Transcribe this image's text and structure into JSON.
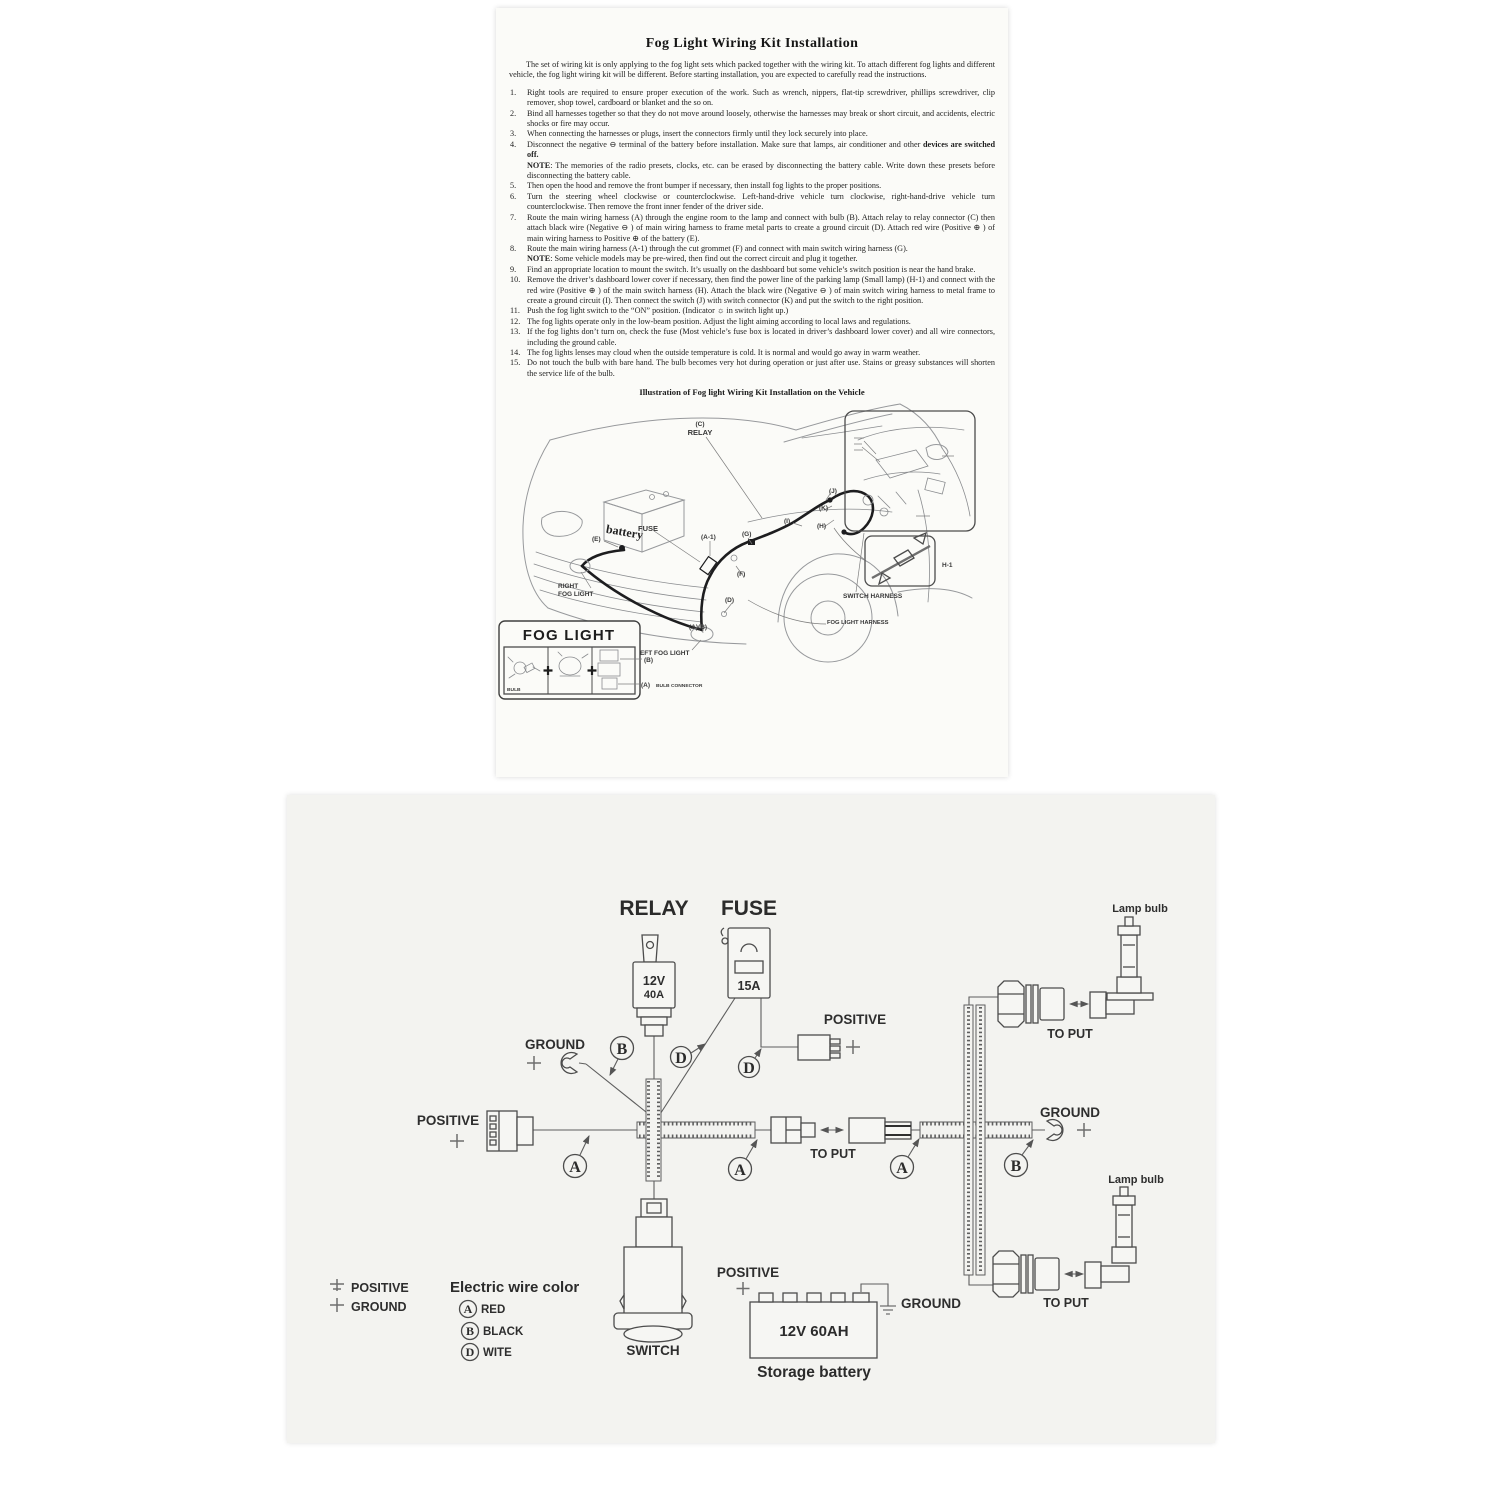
{
  "instruction_sheet": {
    "title": "Fog Light Wiring Kit Installation",
    "intro": "The set of wiring kit is only applying to the fog light sets which packed together with the wiring kit.  To attach different fog lights and different vehicle, the fog light wiring kit will be different.  Before starting installation, you are expected to carefully read the instructions.",
    "items": [
      {
        "num": "1.",
        "text": "Right tools are required to ensure proper execution of the work.  Such as wrench, nippers, flat-tip screwdriver, phillips screwdriver, clip remover, shop towel, cardboard or blanket and the so on."
      },
      {
        "num": "2.",
        "text": "Bind all harnesses together so that they do not move around loosely, otherwise the harnesses may break or short circuit, and accidents, electric shocks or fire may occur."
      },
      {
        "num": "3.",
        "text": "When connecting the harnesses or plugs, insert the connectors firmly until they lock securely into place."
      },
      {
        "num": "4.",
        "text": "Disconnect the negative ⊖ terminal of the battery before installation.  Make sure that lamps, air conditioner and other ",
        "bold": "devices are switched off.",
        "note_label": "NOTE",
        "note_text": ": The memories of the radio presets, clocks, etc. can be erased by disconnecting the battery cable.  Write down these presets before disconnecting the battery cable."
      },
      {
        "num": "5.",
        "text": "Then open the hood and remove the front bumper if necessary, then install fog lights to the proper positions."
      },
      {
        "num": "6.",
        "text": "Turn the steering wheel clockwise or counterclockwise.  Left-hand-drive vehicle turn clockwise, right-hand-drive vehicle turn counterclockwise.  Then remove the front inner fender of the driver side."
      },
      {
        "num": "7.",
        "text": "Route the main wiring harness (A) through the engine room to the lamp and connect with bulb (B).  Attach relay to relay connector (C) then attach black wire (Negative ⊖ ) of main wiring harness to frame metal parts to create a ground circuit (D).  Attach red wire (Positive ⊕ ) of main wiring harness to Positive ⊕  of the battery (E)."
      },
      {
        "num": "8.",
        "text": "Route the main wiring harness (A-1) through the cut grommet (F) and connect with main switch wiring harness (G).",
        "note_label": "NOTE",
        "note_text": ": Some vehicle models may be pre-wired, then find out the correct circuit and plug it together."
      },
      {
        "num": "9.",
        "text": "Find an appropriate location to mount the switch. It’s usually on the dashboard but some vehicle’s switch position is near the hand brake."
      },
      {
        "num": "10.",
        "text": "Remove the driver’s dashboard lower cover if necessary, then find the power line of the parking lamp (Small lamp) (H-1) and connect with the red wire (Positive ⊕ ) of the main switch harness (H).  Attach the black wire (Negative ⊖ ) of main switch wiring harness to metal frame to create a ground circuit (I).  Then connect the switch (J) with switch connector (K) and put the switch to the right position."
      },
      {
        "num": "11.",
        "text": "Push the fog light switch to the “ON” position.  (Indicator ☼ in switch light up.)"
      },
      {
        "num": "12.",
        "text": "The fog lights operate only in the low-beam position.  Adjust the light aiming according to local laws and regulations."
      },
      {
        "num": "13.",
        "text": "If the fog lights don’t turn on, check the fuse (Most vehicle’s fuse box is located in driver’s dashboard lower cover) and all wire connectors, including the ground cable."
      },
      {
        "num": "14.",
        "text": "The fog lights lenses may cloud when the outside temperature is cold. It is normal and would go away in warm weather."
      },
      {
        "num": "15.",
        "text": "Do not touch the bulb with bare hand.  The bulb becomes very hot during operation or just after use.  Stains or greasy substances will shorten the service life of the bulb."
      }
    ],
    "illustration_title": "Illustration of Fog light Wiring Kit Installation on the Vehicle",
    "vehicle": {
      "c": "(C)",
      "relay": "RELAY",
      "battery": "battery",
      "fuse": "FUSE",
      "e": "(E)",
      "a1": "(A-1)",
      "g": "(G)",
      "j": "(J)",
      "k": "(K)",
      "i": "(I)",
      "h": "(H)",
      "f": "(F)",
      "d": "(D)",
      "right_fog_1": "RIGHT",
      "right_fog_2": "FOG LIGHT",
      "ab": "(A)(B)",
      "left_fog": "LEFT  FOG  LIGHT",
      "switch_harness": "SWITCH HARNESS",
      "fog_light_harness": "FOG LIGHT HARNESS",
      "h1": "H-1"
    },
    "fog_light_box": {
      "title": "FOG LIGHT",
      "bulb": "BULB",
      "b": "(B)",
      "a": "(A)",
      "a_desc": "BULB CONNECTOR"
    }
  },
  "wiring_diagram": {
    "relay": {
      "label": "RELAY",
      "volts": "12V",
      "amps": "40A"
    },
    "fuse": {
      "label": "FUSE",
      "amps": "15A"
    },
    "labels": {
      "positive": "POSITIVE",
      "ground": "GROUND",
      "to_put": "TO PUT",
      "lamp_bulb": "Lamp bulb",
      "switch": "SWITCH"
    },
    "battery": {
      "rating": "12V  60AH",
      "caption": "Storage battery"
    },
    "wire_codes": {
      "a": "A",
      "b": "B",
      "d": "D"
    },
    "legend": {
      "positive": "POSITIVE",
      "ground": "GROUND",
      "title": "Electric wire color",
      "entries": [
        {
          "code": "A",
          "color": "RED"
        },
        {
          "code": "B",
          "color": "BLACK"
        },
        {
          "code": "D",
          "color": "WITE"
        }
      ]
    },
    "colors": {
      "paper": "#f3f3f0",
      "ink": "#2e2e2e",
      "line": "#5e5e5e"
    }
  }
}
